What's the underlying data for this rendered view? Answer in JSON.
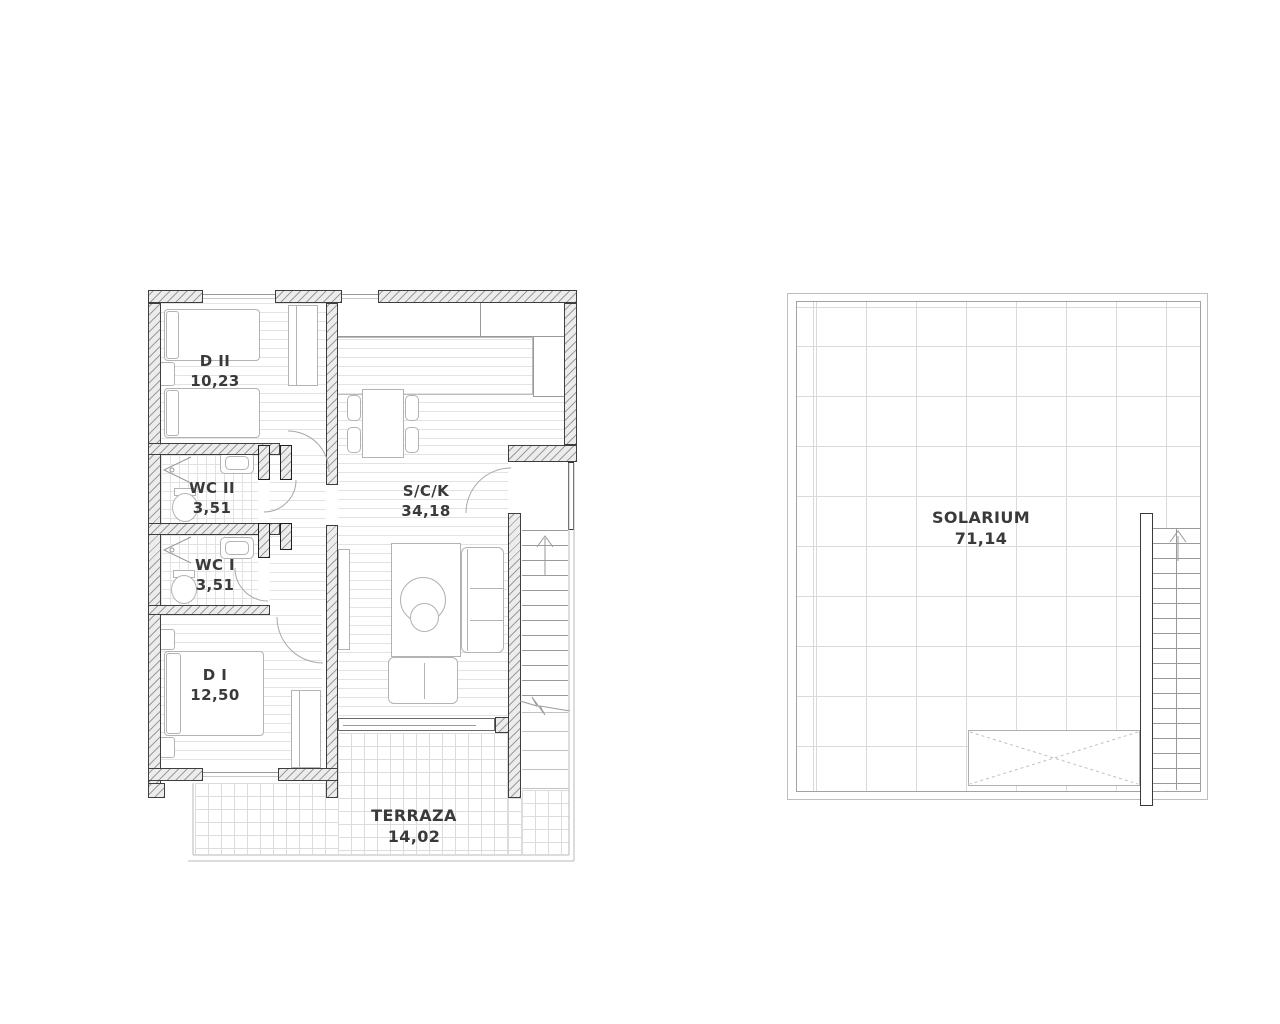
{
  "apartment": {
    "rooms": [
      {
        "name": "D II",
        "area": "10,23"
      },
      {
        "name": "WC II",
        "area": "3,51"
      },
      {
        "name": "WC I",
        "area": "3,51"
      },
      {
        "name": "D I",
        "area": "12,50"
      },
      {
        "name": "S/C/K",
        "area": "34,18"
      },
      {
        "name": "TERRAZA",
        "area": "14,02"
      }
    ]
  },
  "solarium": {
    "rooms": [
      {
        "name": "SOLARIUM",
        "area": "71,14"
      }
    ]
  },
  "colors": {
    "background": "#ffffff",
    "wall_fill": "#ececec",
    "wall_hatch": "#9b9b9b",
    "wall_outline": "#3e3e3e",
    "floor_line": "#e3e3e3",
    "solarium_grid": "#dadada",
    "annotation_line": "#a8a8a8",
    "text": "#3a3a3a"
  }
}
